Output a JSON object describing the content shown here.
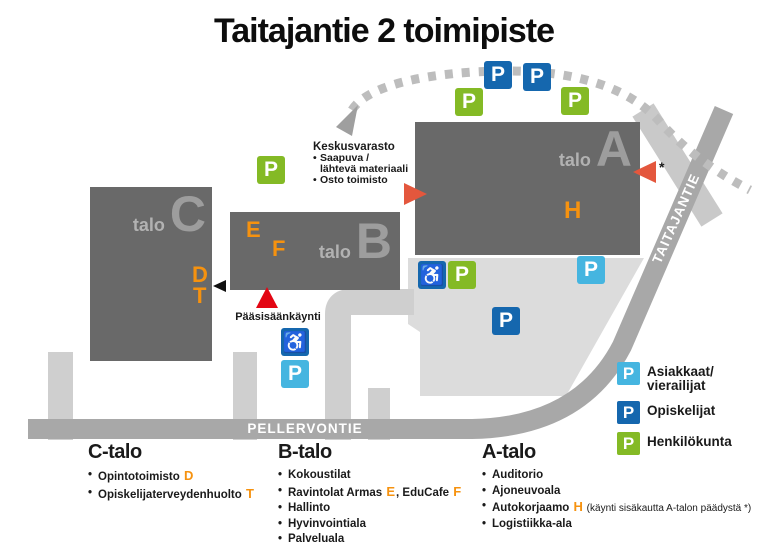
{
  "title": "Taitajantie 2 toimipiste",
  "ui": {
    "bullet": "•"
  },
  "map": {
    "p": "P",
    "wheelchair": "♿",
    "asterisk": "*",
    "buildings": [
      {
        "prefix": "talo",
        "letter": "C"
      },
      {
        "prefix": "talo",
        "letter": "B"
      },
      {
        "prefix": "talo",
        "letter": "A"
      }
    ],
    "rooms": {
      "d": "D",
      "t": "T",
      "e": "E",
      "f": "F",
      "h": "H"
    },
    "roads": {
      "pellervontie": "PELLERVONTIE",
      "taitajantie": "TAITAJANTIE"
    },
    "keskusvarasto": {
      "title": "Keskusvarasto",
      "line1a": "Saapuva /",
      "line1b": "lähtevä materiaali",
      "line2": "Osto toimisto"
    },
    "entrance_label": "Pääsisäänkäynti",
    "markers": [
      {
        "type": "staff",
        "area": "north-row"
      },
      {
        "type": "student",
        "area": "north-row"
      },
      {
        "type": "student",
        "area": "north-row"
      },
      {
        "type": "staff",
        "area": "north-row"
      },
      {
        "type": "staff",
        "area": "keskusvarasto"
      },
      {
        "type": "wheelchair",
        "area": "south-of-A"
      },
      {
        "type": "staff",
        "area": "south-of-A"
      },
      {
        "type": "visitor",
        "area": "south-of-A"
      },
      {
        "type": "student",
        "area": "parking-lot"
      },
      {
        "type": "wheelchair",
        "area": "main-entrance"
      },
      {
        "type": "visitor",
        "area": "main-entrance"
      }
    ]
  },
  "legend": [
    {
      "type": "visitor",
      "line1": "Asiakkaat/",
      "line2": "vierailijat"
    },
    {
      "type": "student",
      "line1": "Opiskelijat",
      "line2": ""
    },
    {
      "type": "staff",
      "line1": "Henkilökunta",
      "line2": ""
    }
  ],
  "info": [
    {
      "name": "C-talo",
      "items": [
        {
          "pre": "Opintotoimisto ",
          "hl": "D"
        },
        {
          "pre": "Opiskelijaterveydenhuolto ",
          "hl": "T"
        }
      ]
    },
    {
      "name": "B-talo",
      "items": [
        {
          "pre": "Kokoustilat"
        },
        {
          "pre": "Ravintolat Armas ",
          "hl": "E",
          "mid": ", EduCafe ",
          "hl2": "F"
        },
        {
          "pre": "Hallinto"
        },
        {
          "pre": "Hyvinvointiala"
        },
        {
          "pre": "Palveluala"
        }
      ]
    },
    {
      "name": "A-talo",
      "items": [
        {
          "pre": "Auditorio"
        },
        {
          "pre": "Ajoneuvoala"
        },
        {
          "pre": "Autokorjaamo ",
          "hl": "H",
          "note": " (käynti sisäkautta A-talon päädystä *)"
        },
        {
          "pre": "Logistiikka-ala"
        }
      ]
    }
  ],
  "colors": {
    "visitor": "#45b5e0",
    "student": "#1567ae",
    "staff": "#84ba25",
    "building": "#696969",
    "room_letter": "#f6920f",
    "main_entrance_triangle": "#e30613",
    "a_entrance_triangle": "#e4573d",
    "main_road": "#a8a8a8",
    "minor_road": "#cfcfcf",
    "parking_area": "#dcdcdc",
    "dashed_route": "#bdbdbd"
  }
}
